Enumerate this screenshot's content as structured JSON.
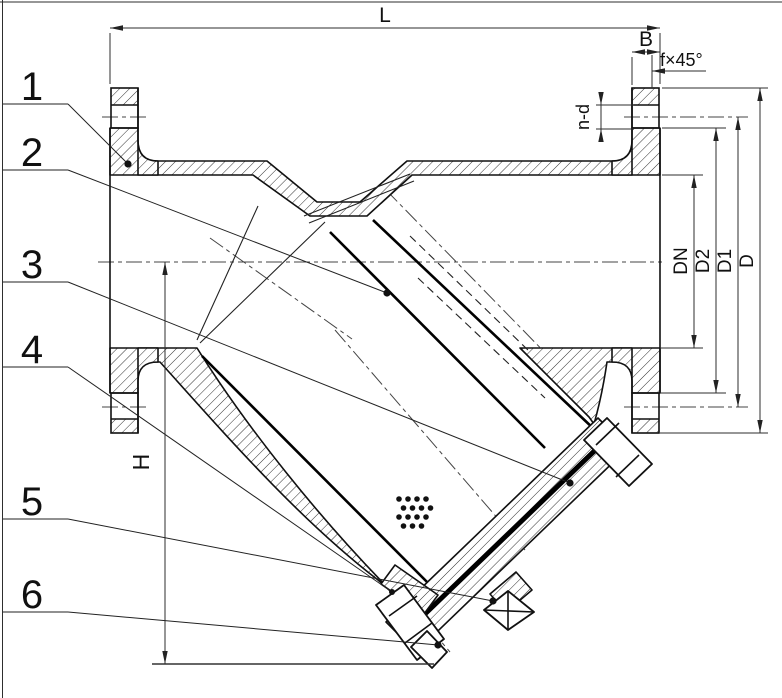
{
  "drawing": {
    "callouts": [
      {
        "number": "1"
      },
      {
        "number": "2"
      },
      {
        "number": "3"
      },
      {
        "number": "4"
      },
      {
        "number": "5"
      },
      {
        "number": "6"
      }
    ],
    "dimensions": {
      "overall_length": "L",
      "flange_thickness": "B",
      "chamfer": "f×45°",
      "bolt_holes": "n-d",
      "nominal_diameter": "DN",
      "raised_face_diameter": "D2",
      "bolt_circle_diameter": "D1",
      "flange_outer_diameter": "D",
      "height_to_drain": "H"
    },
    "colors": {
      "ink": "#111111",
      "dimension_line": "#2e2e2e",
      "background": "#ffffff"
    }
  }
}
